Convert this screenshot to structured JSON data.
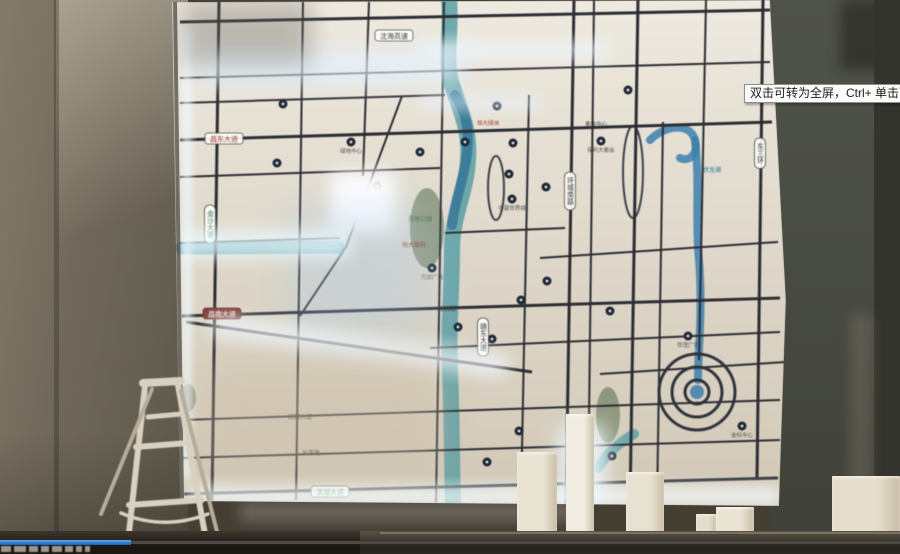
{
  "player": {
    "tooltip": "双击可转为全屏，Ctrl+ 单击可转为",
    "progress_pct": 14.5,
    "progress_color": "#2e7ece",
    "watermark_marks": [
      [
        1,
        10
      ],
      [
        14,
        12
      ],
      [
        29,
        9
      ],
      [
        41,
        8
      ],
      [
        52,
        10
      ],
      [
        65,
        8
      ],
      [
        76,
        6
      ],
      [
        85,
        5
      ]
    ]
  },
  "scene": {
    "map": {
      "outline": "172,2 770,0 786,300 779,506 180,501",
      "bg": [
        "#efeae0",
        "#ddd6c8",
        "#d2c8b7"
      ],
      "road_color": "#2b2d33",
      "green_color": "#5f7352",
      "roads": [
        [
          180,
          22,
          770,
          10,
          3
        ],
        [
          180,
          78,
          770,
          62,
          2
        ],
        [
          180,
          103,
          445,
          95,
          2
        ],
        [
          180,
          140,
          772,
          122,
          3
        ],
        [
          180,
          177,
          440,
          168,
          2
        ],
        [
          445,
          233,
          565,
          228,
          2
        ],
        [
          540,
          258,
          778,
          242,
          2
        ],
        [
          180,
          243,
          340,
          238,
          2
        ],
        [
          182,
          316,
          780,
          298,
          3
        ],
        [
          430,
          348,
          780,
          332,
          2
        ],
        [
          600,
          374,
          786,
          362,
          2
        ],
        [
          182,
          420,
          780,
          400,
          2
        ],
        [
          183,
          458,
          780,
          440,
          2
        ],
        [
          184,
          494,
          778,
          478,
          3
        ],
        [
          219,
          2,
          212,
          500,
          3
        ],
        [
          303,
          2,
          296,
          500,
          2
        ],
        [
          369,
          2,
          363,
          176,
          2
        ],
        [
          444,
          2,
          436,
          502,
          2
        ],
        [
          529,
          95,
          521,
          500,
          2
        ],
        [
          574,
          0,
          566,
          505,
          3
        ],
        [
          594,
          0,
          588,
          505,
          2
        ],
        [
          638,
          0,
          630,
          505,
          3
        ],
        [
          663,
          122,
          657,
          505,
          2
        ],
        [
          706,
          0,
          699,
          360,
          2
        ],
        [
          763,
          0,
          757,
          478,
          3
        ],
        [
          402,
          96,
          346,
          247,
          2
        ],
        [
          346,
          247,
          300,
          316,
          2
        ],
        [
          186,
          322,
          532,
          372,
          3
        ]
      ],
      "waters": [
        {
          "d": "M449,0 C452,30 444,60 452,85 C462,115 470,130 468,160 C466,195 452,215 452,250 C452,290 448,330 450,370 C452,420 452,470 453,510",
          "w": 16,
          "c": "#4f9aa0",
          "o": 0.8
        },
        {
          "d": "M455,95 C468,115 470,135 466,160 C462,185 455,200 452,225",
          "w": 10,
          "c": "#2e6e94",
          "o": 0.75
        },
        {
          "d": "M182,248 L338,247",
          "w": 13,
          "c": "#4f9aa0",
          "o": 0.85
        },
        {
          "d": "M650,140 C665,125 690,122 695,140 C699,155 688,162 680,158",
          "w": 8,
          "c": "#3d7fae",
          "o": 0.85
        },
        {
          "d": "M695,140 C700,180 695,220 699,260 C703,310 698,350 698,380",
          "w": 8,
          "c": "#3d7fae",
          "o": 0.85
        },
        {
          "d": "M598,468 C608,452 620,442 634,434",
          "w": 10,
          "c": "#4f9aa0",
          "o": 0.75
        }
      ],
      "greens": [
        [
          427,
          228,
          17,
          40
        ],
        [
          608,
          415,
          12,
          28
        ],
        [
          188,
          398,
          8,
          14
        ]
      ],
      "rings": [
        [
          496,
          188,
          8,
          32
        ],
        [
          633,
          172,
          10,
          46
        ]
      ],
      "spiral": {
        "cx": 697,
        "cy": 392,
        "radii": [
          12,
          25,
          38
        ]
      },
      "markers": [
        [
          283,
          104
        ],
        [
          351,
          142,
          "绿地中心"
        ],
        [
          277,
          163
        ],
        [
          377,
          186
        ],
        [
          420,
          152
        ],
        [
          465,
          142
        ],
        [
          497,
          106
        ],
        [
          513,
          143
        ],
        [
          509,
          174
        ],
        [
          512,
          199,
          "中骏世界城"
        ],
        [
          546,
          187
        ],
        [
          601,
          141,
          "保利大都会"
        ],
        [
          628,
          90
        ],
        [
          432,
          268,
          "万达广场"
        ],
        [
          458,
          327
        ],
        [
          492,
          339
        ],
        [
          521,
          300
        ],
        [
          547,
          281
        ],
        [
          610,
          311
        ],
        [
          487,
          462
        ],
        [
          519,
          431
        ],
        [
          612,
          456
        ],
        [
          688,
          336,
          "世茂广场"
        ],
        [
          742,
          426,
          "金科中心"
        ]
      ],
      "labels": [
        {
          "x": 394,
          "y": 30,
          "t": "沈海高速",
          "k": "hpill",
          "fg": "#333333"
        },
        {
          "x": 224,
          "y": 133,
          "t": "昌东大道",
          "k": "hpill",
          "fg": "#a63c31"
        },
        {
          "x": 222,
          "y": 308,
          "t": "昌南大道",
          "k": "hpill",
          "fg": "#ffffff",
          "bg": "#7c3a30",
          "bd": "#5d2a22"
        },
        {
          "x": 330,
          "y": 486,
          "t": "滨湖大道",
          "k": "hpill",
          "fg": "#2e7d4f"
        },
        {
          "x": 311,
          "y": 455,
          "t": "长青路",
          "k": "plain",
          "fg": "#3a3a3a",
          "fs": 6
        },
        {
          "x": 447,
          "y": 311,
          "t": "站前路",
          "k": "plain",
          "fg": "#3a3a3a",
          "fs": 6
        },
        {
          "x": 300,
          "y": 419,
          "t": "迎宾大道",
          "k": "plain",
          "fg": "#3a3a3a",
          "fs": 6
        },
        {
          "x": 210,
          "y": 205,
          "t": "金沙大道",
          "k": "vpill",
          "fg": "#2e7d4f"
        },
        {
          "x": 483,
          "y": 318,
          "t": "赣东大道",
          "k": "vpill",
          "fg": "#3a3a3a"
        },
        {
          "x": 570,
          "y": 172,
          "t": "环城南路",
          "k": "vpill",
          "fg": "#3a3a3a"
        },
        {
          "x": 760,
          "y": 138,
          "t": "东三环",
          "k": "vpill",
          "fg": "#3a3a3a"
        },
        {
          "x": 712,
          "y": 172,
          "t": "伏龙湖",
          "k": "plain",
          "fg": "#27708e",
          "fs": 6
        },
        {
          "x": 420,
          "y": 221,
          "t": "湿地公园",
          "k": "plain",
          "fg": "#3c6b33",
          "fs": 6
        },
        {
          "x": 414,
          "y": 247,
          "t": "恒大御府",
          "k": "plain",
          "fg": "#a33226",
          "fs": 6
        },
        {
          "x": 596,
          "y": 126,
          "t": "奥体中心",
          "k": "plain",
          "fg": "#3a3a3a",
          "fs": 5.5
        },
        {
          "x": 488,
          "y": 125,
          "t": "恒大绿洲",
          "k": "plain",
          "fg": "#a33226",
          "fs": 5.5
        }
      ],
      "glows": [
        [
          183,
          30,
          8,
          450,
          4,
          "#f2faff",
          0.9,
          0
        ],
        [
          196,
          50,
          270,
          34,
          10,
          "#e4f2ff",
          0.7,
          0
        ],
        [
          420,
          42,
          190,
          16,
          8,
          "#eef8ff",
          0.75,
          0
        ],
        [
          420,
          95,
          120,
          14,
          7,
          "#e8f4ff",
          0.6,
          0
        ],
        [
          182,
          0,
          130,
          66,
          12,
          "#62625c",
          0.35,
          0
        ],
        [
          330,
          172,
          66,
          62,
          9,
          "#ffffff",
          1,
          0
        ],
        [
          290,
          205,
          140,
          130,
          22,
          "#a9c8e6",
          0.35,
          0
        ],
        [
          180,
          230,
          170,
          28,
          8,
          "#ecfbff",
          0.75,
          0
        ],
        [
          209,
          336,
          300,
          20,
          9,
          "#f2faff",
          0.85,
          8
        ],
        [
          200,
          360,
          240,
          120,
          20,
          "#cdbfa8",
          0.45,
          0
        ],
        [
          186,
          488,
          596,
          16,
          8,
          "#f4fcff",
          0.95,
          0
        ],
        [
          560,
          425,
          46,
          85,
          10,
          "#ecf8ff",
          0.9,
          0
        ]
      ]
    },
    "ladder": {
      "color": "#d8d1c1",
      "dark": "#b5ac99",
      "segments": [
        [
          143,
          383,
          181,
          381,
          8
        ],
        [
          145,
          386,
          127,
          551,
          6
        ],
        [
          178,
          385,
          208,
          551,
          6
        ],
        [
          181,
          391,
          222,
          551,
          4,
          "#b5ac99"
        ],
        [
          152,
          389,
          101,
          514,
          4,
          "#b5ac99"
        ],
        [
          148,
          417,
          181,
          414,
          5
        ],
        [
          136,
          447,
          188,
          443,
          6
        ],
        [
          129,
          505,
          202,
          500,
          6
        ]
      ],
      "arc": "M121,513 Q163,531 208,514"
    },
    "blocks": [
      [
        517,
        452,
        40,
        102,
        "#e9e3d3"
      ],
      [
        566,
        414,
        28,
        140,
        "#f1ece0"
      ],
      [
        626,
        472,
        38,
        82,
        "#e7e1d1"
      ],
      [
        696,
        514,
        20,
        40,
        "#e4ddcc"
      ],
      [
        716,
        507,
        38,
        47,
        "#eae4d4"
      ],
      [
        832,
        476,
        68,
        78,
        "#e6decc"
      ]
    ]
  }
}
